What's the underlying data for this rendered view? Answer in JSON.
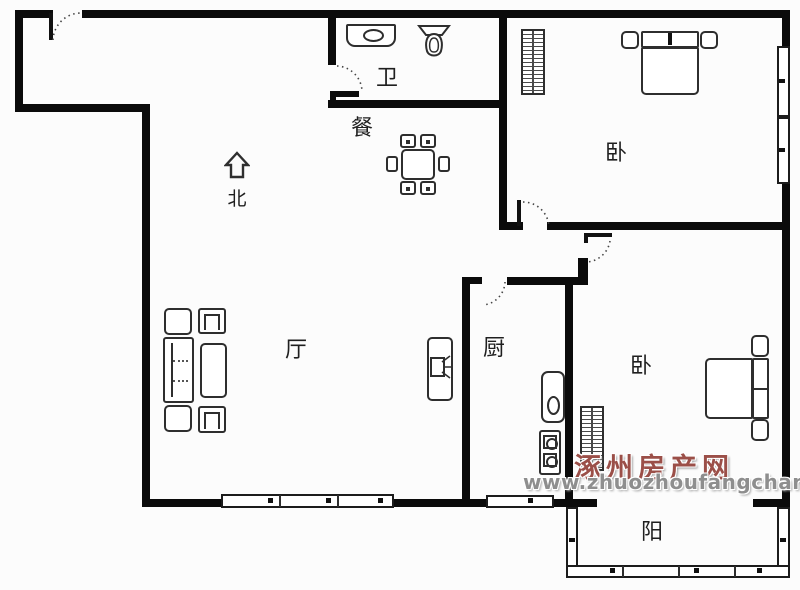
{
  "compass": {
    "label": "北"
  },
  "rooms": {
    "bathroom": {
      "label": "卫"
    },
    "dining": {
      "label": "餐"
    },
    "bedroom1": {
      "label": "卧"
    },
    "living": {
      "label": "厅"
    },
    "kitchen": {
      "label": "厨"
    },
    "bedroom2": {
      "label": "卧"
    },
    "balcony": {
      "label": "阳"
    }
  },
  "watermark": {
    "site_name": "涿州房产网",
    "site_url": "www.zhuozhoufangchan.com",
    "site_name_color": "#9b4f48",
    "site_url_color": "#8e8e8e"
  },
  "colors": {
    "wall": "#0b0b0b",
    "furniture_line": "#2e2e2e",
    "background": "#fcfcfc"
  }
}
